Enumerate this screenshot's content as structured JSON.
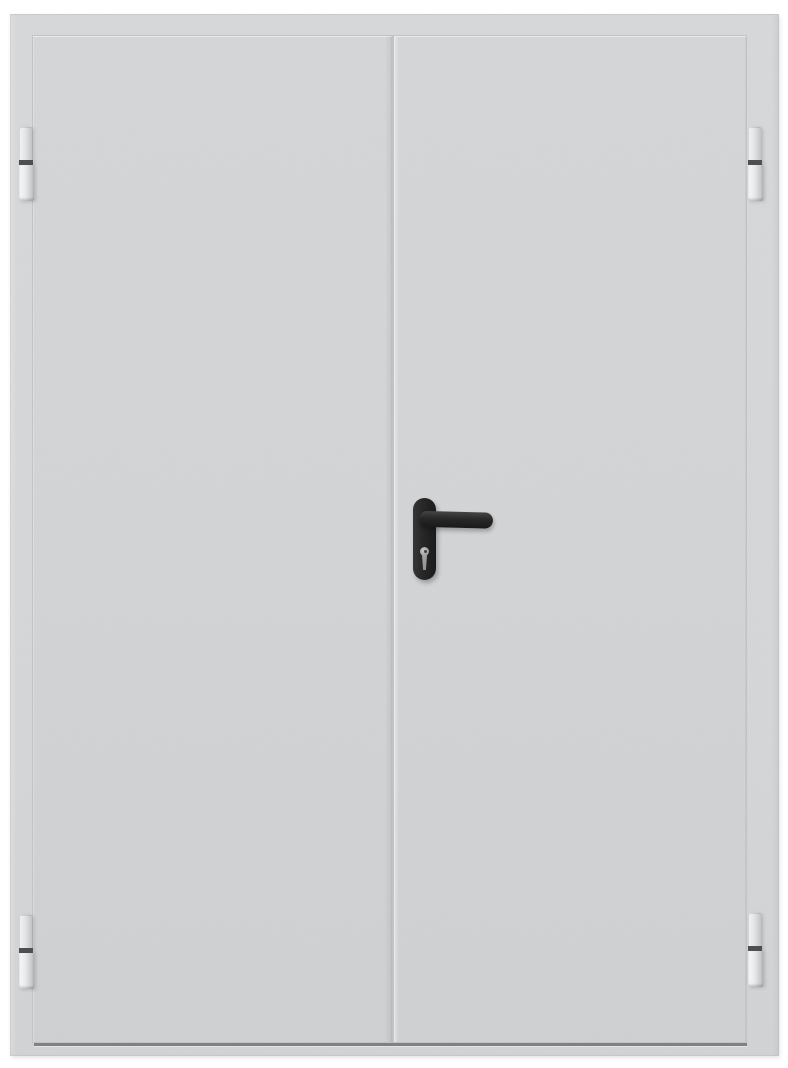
{
  "scene": {
    "description": "Front-view product photograph of a closed double-leaf gray metal fire door on a plain white background",
    "photo_width_px": 788,
    "photo_height_px": 1068
  },
  "door": {
    "type": "double-leaf metal door",
    "finish": "light gray textured powder coat",
    "leaf_count": 2,
    "active_leaf": "right",
    "hinges": [
      {
        "position": "top-left"
      },
      {
        "position": "bottom-left"
      },
      {
        "position": "top-right"
      },
      {
        "position": "bottom-right"
      }
    ],
    "hardware": {
      "handle": "black lever handle on rounded oval backplate",
      "lock": "euro-cylinder keyhole below lever"
    }
  },
  "colors": {
    "photo-bg": "#ffffff",
    "frame-gray": "#d7d8da",
    "leaf-gray": "#d5d6d8",
    "edge-line": "#c2c3c6",
    "edge-highlight": "#e9eaec",
    "hinge-body": "#e4e5e6",
    "hinge-band": "#4a4b4e",
    "handle-black": "#232323",
    "keyhole-gray": "#a3a3a5",
    "threshold-dark": "#707174"
  }
}
